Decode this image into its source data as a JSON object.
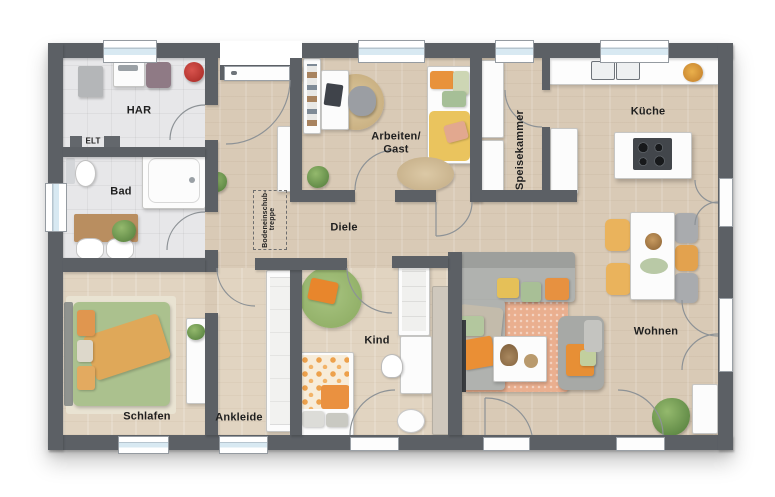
{
  "type": "floor-plan",
  "rooms": {
    "har": {
      "label": "HAR"
    },
    "elt": {
      "label": "ELT"
    },
    "bad": {
      "label": "Bad"
    },
    "schlafen": {
      "label": "Schlafen"
    },
    "ankleide": {
      "label": "Ankleide"
    },
    "kind": {
      "label": "Kind"
    },
    "diele": {
      "label": "Diele"
    },
    "arbeiten_gast": {
      "label_line1": "Arbeiten/",
      "label_line2": "Gast"
    },
    "speisekammer": {
      "label": "Speisekammer"
    },
    "kueche": {
      "label": "Küche"
    },
    "wohnen": {
      "label": "Wohnen"
    },
    "loft_hatch": {
      "label_line1": "Bodeneinschub-",
      "label_line2": "treppe"
    }
  },
  "colors": {
    "wall": "#5c6065",
    "wood_floor": "#d9cab6",
    "wood_floor_light": "#e1d4c1",
    "tile_floor": "#e7e7e9",
    "window_glass": "#d8e9f2",
    "accent_orange": "#e8923c",
    "accent_green": "#a9c29b",
    "accent_yellow": "#eac45e",
    "rug_salmon": "#eaaf8f",
    "rug_green": "#9cba72",
    "background": "#ffffff"
  }
}
